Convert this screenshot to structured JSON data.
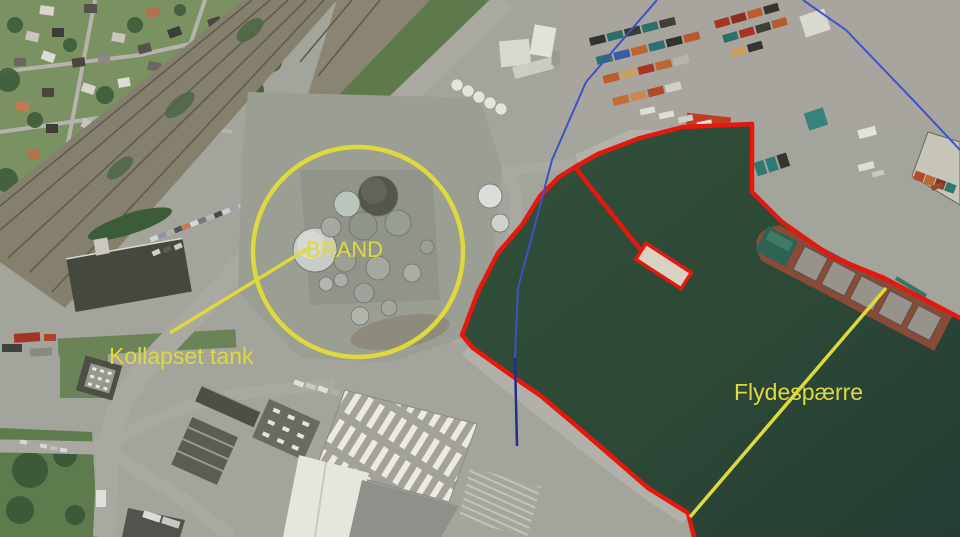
{
  "title": "Aerial harbor incident overview",
  "image": {
    "width": 960,
    "height": 537,
    "kind": "annotated aerial photograph"
  },
  "annotations": {
    "labels": {
      "brand": "BRAND",
      "kollapset_tank": "Kollapset tank",
      "flydespaerre": "Flydespærre"
    },
    "colors": {
      "highlight_yellow": "#ded93c",
      "boundary_red": "#e5170e",
      "route_blue": "#3f51c5",
      "route_blue_dark": "#232e8a",
      "water_green": "#2c4836"
    }
  }
}
